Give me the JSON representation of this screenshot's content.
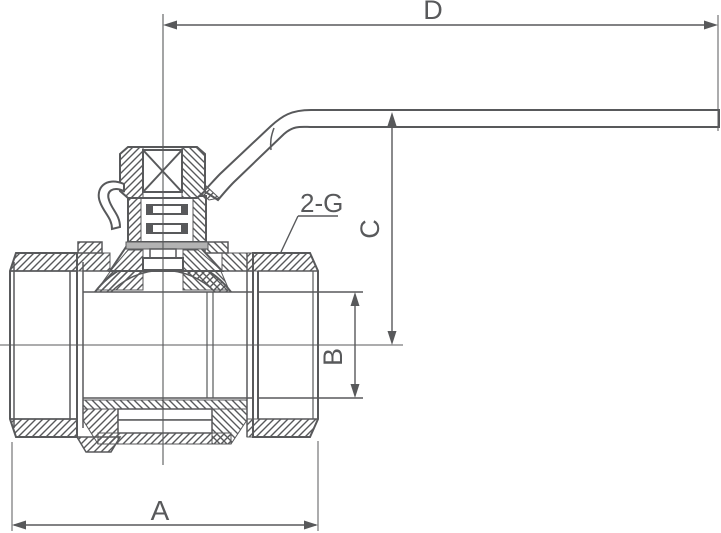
{
  "drawing": {
    "background": "#ffffff",
    "line_color": "#58595b",
    "gasket_color": "#b3b3b3",
    "dimensions": {
      "d": "D",
      "c": "C",
      "b": "B",
      "a": "A"
    },
    "callouts": {
      "thread": "2-G"
    }
  }
}
